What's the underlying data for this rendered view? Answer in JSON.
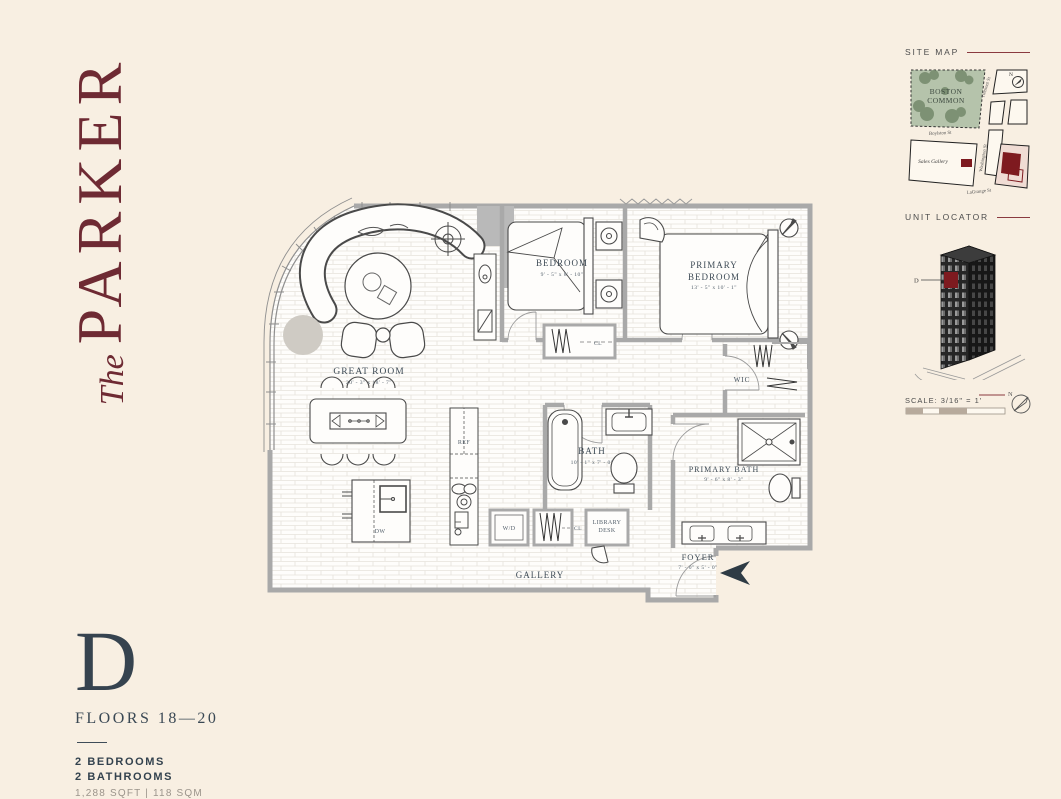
{
  "colors": {
    "background": "#f8efe2",
    "logo_maroon": "#6e2a33",
    "slate": "#3a4854",
    "accent_red": "#7e1a1f",
    "wall_gray": "#a9a9a9"
  },
  "logo": {
    "the": "The",
    "name": "PARKER"
  },
  "plan": {
    "rooms": {
      "great_room": {
        "name": "GREAT ROOM",
        "dims": "20' - 3\" x 18' - 7\""
      },
      "bedroom": {
        "name": "BEDROOM",
        "dims": "9' - 5\" x 8' - 10\""
      },
      "primary_bedroom": {
        "line1": "PRIMARY",
        "line2": "BEDROOM",
        "dims": "13' - 5\" x 10' - 1\""
      },
      "bath": {
        "name": "BATH",
        "dims": "10' - 1\" x 7' - 0\""
      },
      "primary_bath": {
        "name": "PRIMARY BATH",
        "dims": "9' - 6\" x 8' - 3\""
      },
      "foyer": {
        "name": "FOYER",
        "dims": "7' - 0\" x 5' - 0\""
      },
      "gallery": {
        "name": "GALLERY"
      },
      "wic": {
        "name": "WIC"
      }
    },
    "fixtures": {
      "ref": "REF",
      "dw": "DW",
      "wd": "W/D",
      "cl_hall": "CL",
      "cl_bedroom": "CL",
      "library_line1": "LIBRARY",
      "library_line2": "DESK"
    }
  },
  "sidebar": {
    "site_map": {
      "title": "SITE MAP",
      "park_line1": "BOSTON",
      "park_line2": "COMMON",
      "street_tremont": "Tremont St",
      "street_boylston": "Boylston St",
      "street_washington": "Washington St",
      "street_lagrange": "LaGrange St",
      "sales_gallery": "Sales Gallery",
      "north": "N"
    },
    "unit_locator": {
      "title": "UNIT LOCATOR",
      "unit_marker": "D"
    },
    "scale": {
      "label": "SCALE: 3/16\" = 1'",
      "north": "N"
    }
  },
  "footer": {
    "unit": "D",
    "floors": "FLOORS 18—20",
    "bedrooms": "2 BEDROOMS",
    "bathrooms": "2 BATHROOMS",
    "area": "1,288 SQFT | 118 SQM"
  }
}
